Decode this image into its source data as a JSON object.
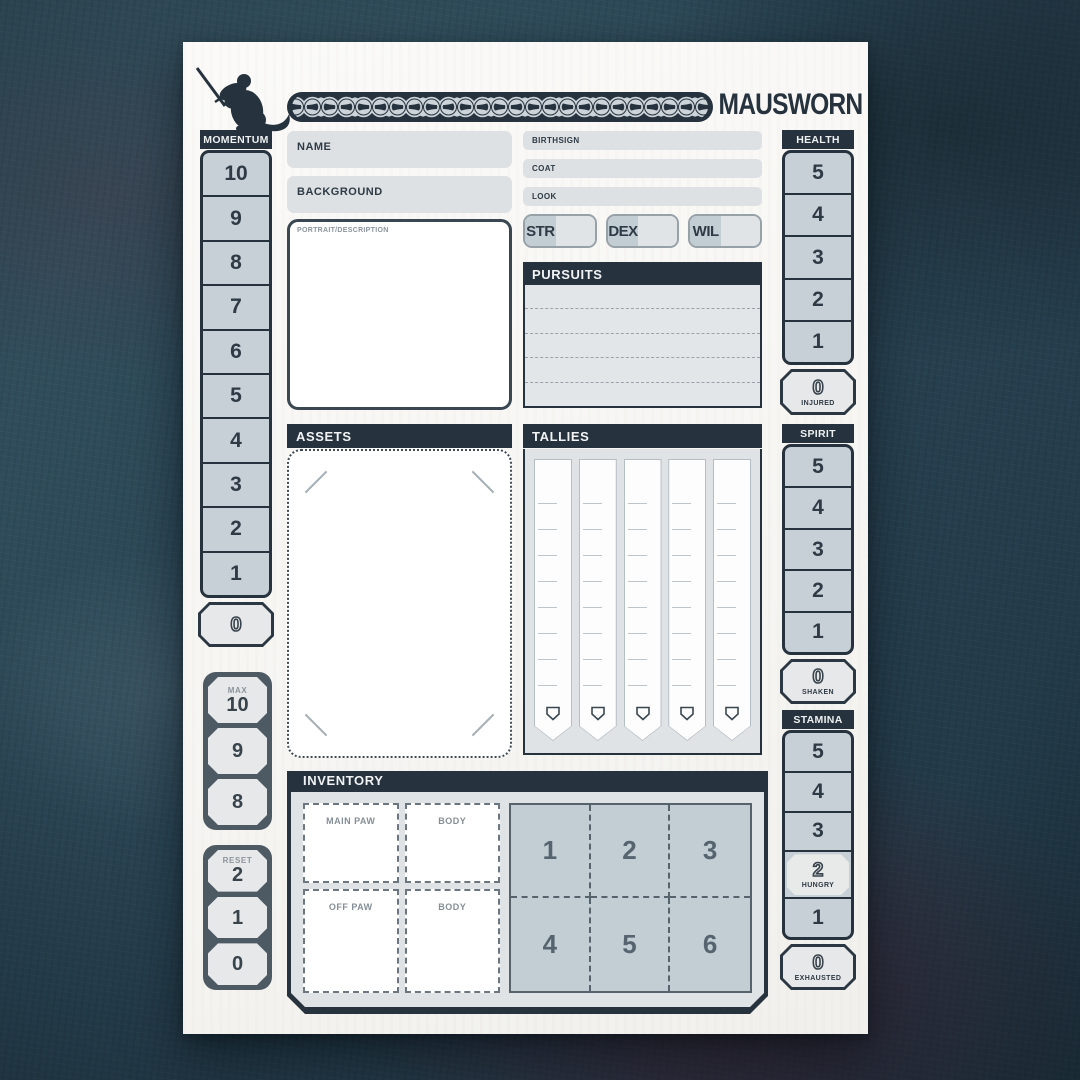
{
  "header": {
    "title": "MAUSWORN",
    "logo": "mouse-with-sword-icon",
    "ornament": "celtic-knot-band"
  },
  "colors": {
    "navy": "#26323d",
    "cell_fill": "#c7d0d7",
    "light_fill": "#e6e8e9",
    "field_fill": "#dde1e4",
    "slate": "#4d5a64",
    "paper": "#f8f7f4",
    "background": "#2c4857",
    "maroon_patch": "#4a1a2c"
  },
  "momentum": {
    "title": "MOMENTUM",
    "cells": [
      "10",
      "9",
      "8",
      "7",
      "6",
      "5",
      "4",
      "3",
      "2",
      "1"
    ],
    "zero": "0"
  },
  "momentum_max": {
    "label": "MAX",
    "cells": [
      "10",
      "9",
      "8"
    ]
  },
  "momentum_reset": {
    "label": "RESET",
    "cells": [
      "2",
      "1",
      "0"
    ]
  },
  "identity": {
    "name_label": "NAME",
    "background_label": "BACKGROUND",
    "birthsign_label": "BIRTHSIGN",
    "coat_label": "COAT",
    "look_label": "LOOK",
    "portrait_label": "PORTRAIT/DESCRIPTION"
  },
  "stats": [
    {
      "label": "STR"
    },
    {
      "label": "DEX"
    },
    {
      "label": "WIL"
    }
  ],
  "pursuits": {
    "title": "PURSUITS",
    "row_count": 5
  },
  "assets": {
    "title": "ASSETS"
  },
  "tallies": {
    "title": "TALLIES",
    "strip_count": 5
  },
  "inventory": {
    "title": "INVENTORY",
    "slots": [
      "MAIN PAW",
      "BODY",
      "OFF PAW",
      "BODY"
    ],
    "grid": [
      "1",
      "2",
      "3",
      "4",
      "5",
      "6"
    ]
  },
  "health": {
    "title": "HEALTH",
    "cells": [
      "5",
      "4",
      "3",
      "2",
      "1"
    ],
    "zero": {
      "value": "0",
      "label": "INJURED"
    }
  },
  "spirit": {
    "title": "SPIRIT",
    "cells": [
      "5",
      "4",
      "3",
      "2",
      "1"
    ],
    "zero": {
      "value": "0",
      "label": "SHAKEN"
    }
  },
  "stamina": {
    "title": "STAMINA",
    "cells_top": [
      "5",
      "4",
      "3"
    ],
    "hungry": {
      "value": "2",
      "label": "HUNGRY"
    },
    "cells_bottom": [
      "1"
    ],
    "zero": {
      "value": "0",
      "label": "EXHAUSTED"
    }
  }
}
